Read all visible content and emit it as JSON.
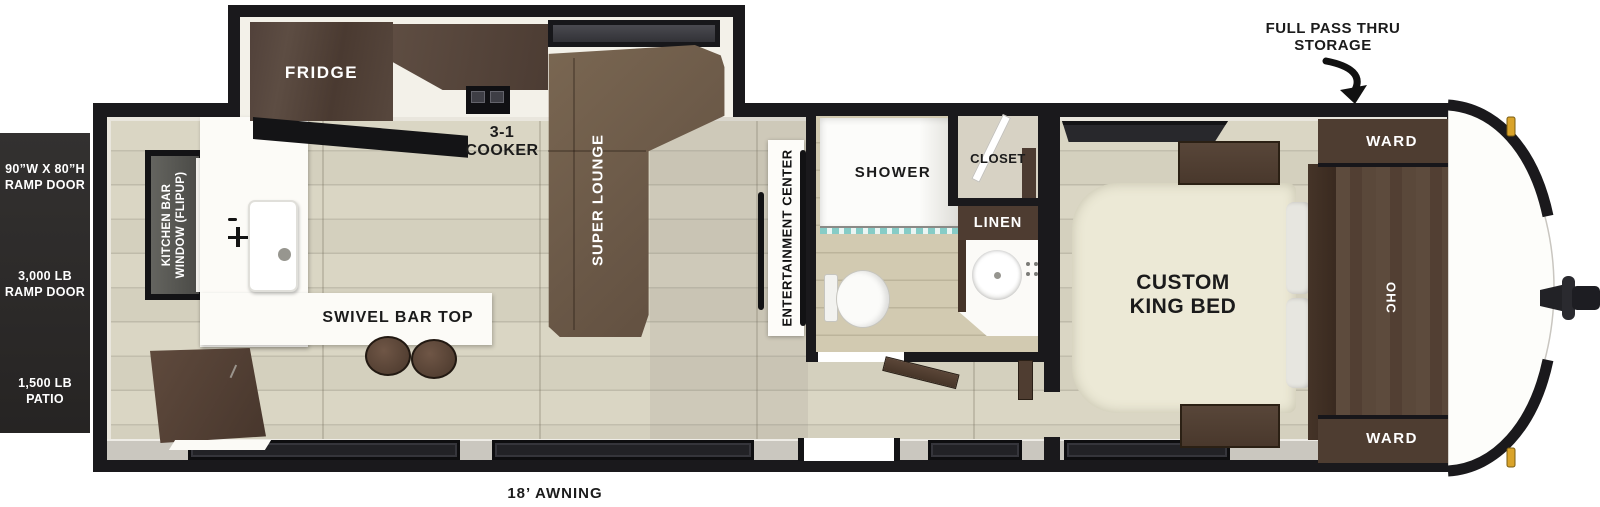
{
  "title": "Travel Trailer Floorplan",
  "exterior": {
    "full_pass_thru": "FULL PASS THRU STORAGE",
    "awning": "18’ AWNING",
    "ramp_door": {
      "size": "90”W X 80”H RAMP DOOR",
      "capacity": "3,000 LB RAMP DOOR",
      "patio": "1,500 LB PATIO"
    }
  },
  "kitchen": {
    "window": "KITCHEN BAR WINDOW (FLIPUP)",
    "fridge": "FRIDGE",
    "cooker": "3-1 COOKER",
    "bar_top": "SWIVEL BAR TOP"
  },
  "living": {
    "lounge": "SUPER LOUNGE",
    "entertainment": "ENTERTAINMENT CENTER"
  },
  "bathroom": {
    "shower": "SHOWER",
    "closet": "CLOSET",
    "linen": "LINEN"
  },
  "bedroom": {
    "bed": "CUSTOM KING BED",
    "ward_top": "WARD",
    "ward_bottom": "WARD",
    "ohc": "OHC"
  },
  "colors": {
    "wall": "#1a191c",
    "floor_wood": "#d8d4c2",
    "cabinet_dark_wood": "#4e3d31",
    "lounge_brown": "#6e5b49",
    "bed_cream": "#ece9d6",
    "accent_gold": "#d9a32a",
    "curtain_teal": "#86ccc6",
    "ramp_panel": "#2b2927"
  }
}
